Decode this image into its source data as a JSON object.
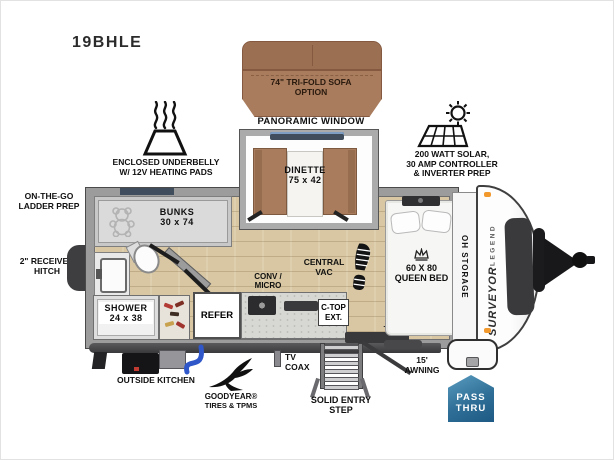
{
  "model": "19BHLE",
  "brand": {
    "name": "SURVEYOR",
    "series": "LEGEND"
  },
  "colors": {
    "sofa_brown": "#a87c5d",
    "floor_wood": "#d8c7a2",
    "wall_gray": "#9c9c9c",
    "window_slate": "#3f4d5c",
    "chassis_dark": "#39393b",
    "pass_thru_blue": "#2f6f97",
    "hose_blue": "#2f57c9",
    "marker_orange": "#f2992e"
  },
  "callouts": {
    "sofa": [
      "74\" TRI-FOLD SOFA",
      "OPTION"
    ],
    "panoramic_window": "PANORAMIC WINDOW",
    "solar": [
      "200 WATT SOLAR,",
      "30 AMP CONTROLLER",
      "& INVERTER PREP"
    ],
    "underbelly": [
      "ENCLOSED UNDERBELLY",
      "W/ 12V HEATING PADS"
    ],
    "ladder_prep": [
      "ON-THE-GO",
      "LADDER PREP"
    ],
    "receiver_hitch": [
      "2\" RECEIVER",
      "HITCH"
    ],
    "outside_kitchen": "OUTSIDE KITCHEN",
    "goodyear": [
      "GOODYEAR®",
      "TIRES & TPMS"
    ],
    "tv_coax": [
      "TV",
      "COAX"
    ],
    "entry_step": [
      "SOLID ENTRY",
      "STEP"
    ],
    "awning": "15' AWNING",
    "pass_thru": [
      "PASS",
      "THRU"
    ]
  },
  "rooms": {
    "dinette": [
      "DINETTE",
      "75 x 42"
    ],
    "bunks": [
      "BUNKS",
      "30 x 74"
    ],
    "shower": [
      "SHOWER",
      "24 x 38"
    ],
    "refer": "REFER",
    "conv_micro": [
      "CONV /",
      "MICRO"
    ],
    "central_vac": [
      "CENTRAL",
      "VAC"
    ],
    "ctop_ext": [
      "C-TOP",
      "EXT."
    ],
    "queen_bed": [
      "60 X 80",
      "QUEEN BED"
    ],
    "oh_storage": "OH STORAGE",
    "tv": "TV"
  }
}
